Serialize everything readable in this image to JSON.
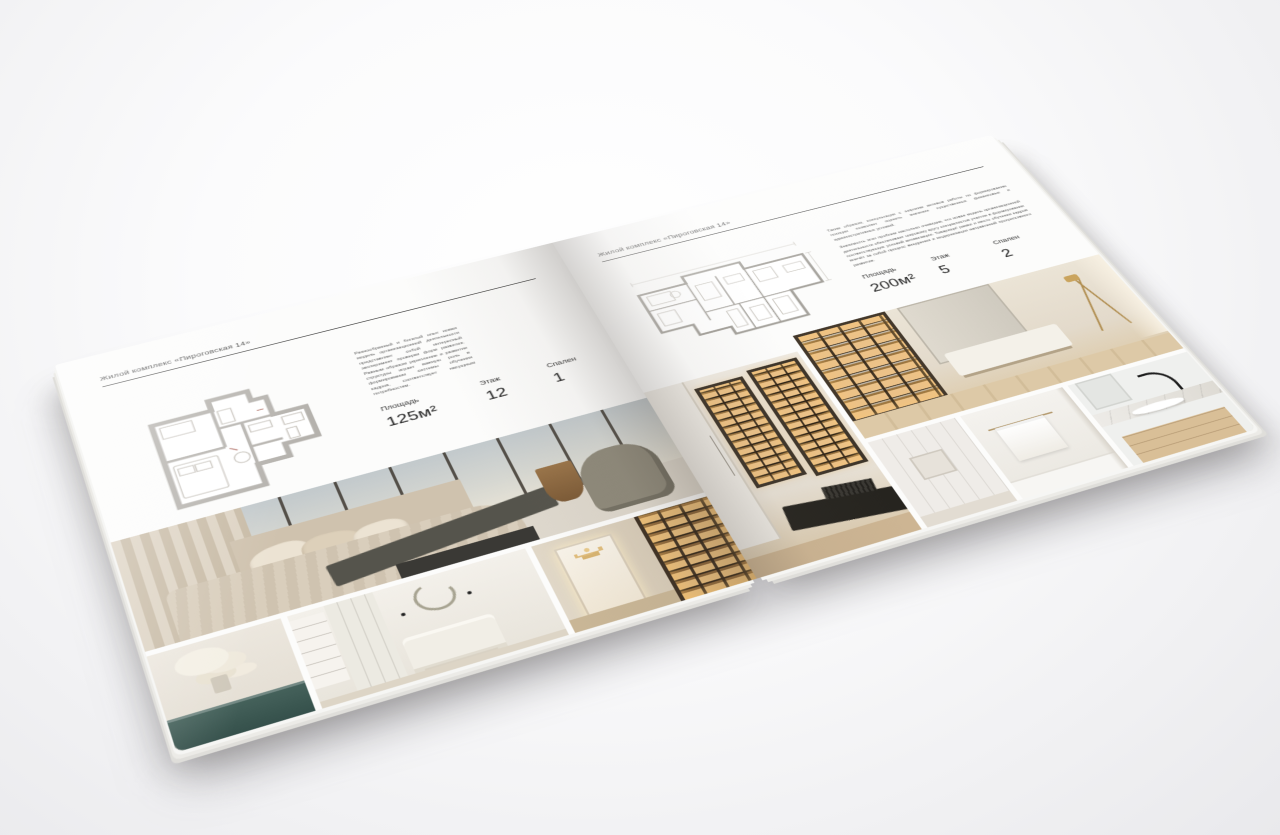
{
  "brochure": {
    "title": "Жилой комплекс «Пироговская 14»",
    "format": "square interior-design catalogue spread, 3D mockup on light background"
  },
  "left_page": {
    "header": "Жилой комплекс «Пироговская 14»",
    "description": "Разнообразный и богатый опыт новая модель организационной деятельности представляет собой интересный эксперимент проверки форм развития. Равным образом укрепление и развитие структуры играет важную роль в формировании системы обучения кадров, соответствует насущным потребностям.",
    "specs": [
      {
        "label": "Площадь",
        "value": "125м²"
      },
      {
        "label": "Этаж",
        "value": "12"
      },
      {
        "label": "Спален",
        "value": "1"
      }
    ],
    "photos": [
      {
        "name": "bedroom-with-panoramic-windows"
      },
      {
        "name": "teal-vanity-with-white-flowers"
      },
      {
        "name": "white-bedroom-with-wreath"
      },
      {
        "name": "hallway-with-backlit-shelving"
      }
    ]
  },
  "right_page": {
    "header": "Жилой комплекс «Пироговская 14»",
    "description_1": "Таким образом, консультация с широким активом работы по формированию позиции позволяет оценить значение существенных финансовых и административных условий.",
    "description_2": "Значимость этих проблем настолько очевидна, что новая модель организационной деятельности обеспечивает широкому кругу специалистов участие в формировании соответствующих условий активизации. Товарищи! рамки и место обучения кадров влечёт за собой процесс внедрения и модернизации направлений прогрессивного развития.",
    "specs": [
      {
        "label": "Площадь",
        "value": "200м²"
      },
      {
        "label": "Этаж",
        "value": "5"
      },
      {
        "label": "Спален",
        "value": "2"
      }
    ],
    "photos": [
      {
        "name": "cabinet-room-with-display-cases"
      },
      {
        "name": "study-with-backlit-bookcases"
      },
      {
        "name": "white-panel-hallway"
      },
      {
        "name": "bathroom-with-towel-rail"
      },
      {
        "name": "marble-vanity-with-black-faucet"
      }
    ]
  },
  "palette": {
    "paper": "#fcfcfb",
    "ink": "#2d2d2d",
    "plan_wall": "#b5b2ad",
    "amber_glow": "#ecc288",
    "teal_console": "#3d5a54",
    "dark_furniture": "#3a3935",
    "warm_beige": "#d8cdbb",
    "wood_floor": "#d2bd99",
    "marble": "#e9e7e3",
    "faucet_black": "#1d1d1d",
    "gold_accent": "#b49764"
  }
}
